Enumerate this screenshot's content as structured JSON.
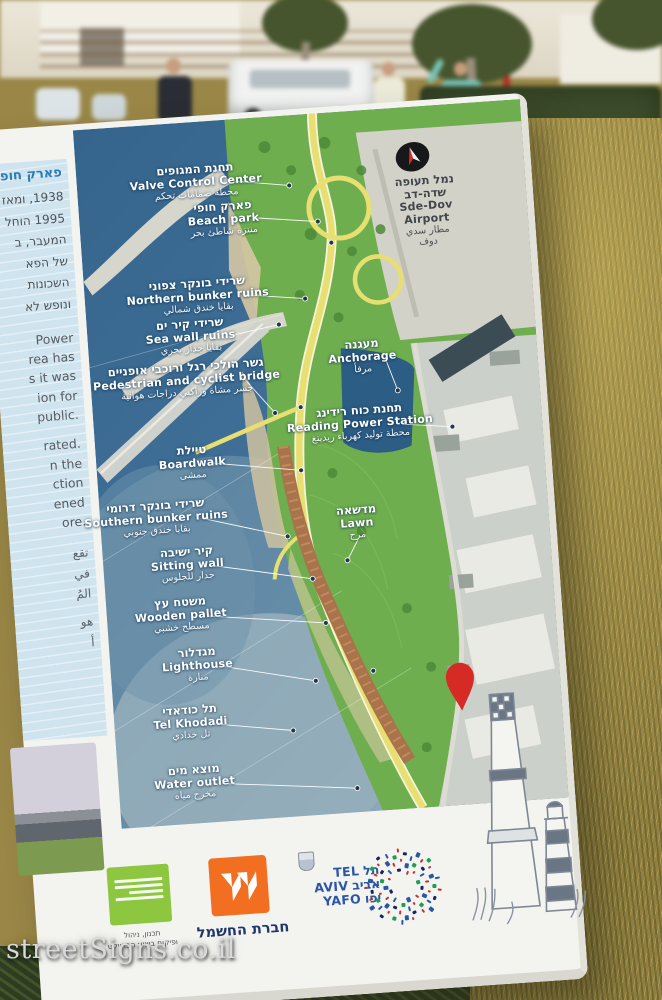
{
  "watermark": "streetSigns.co.il",
  "colors": {
    "sea": "#3f6f96",
    "park_green": "#6fae4e",
    "path_yellow": "#e7df72",
    "boardwalk_brown": "#a9744b",
    "urban_gray": "#cbd0ca",
    "column_blue": "#cfe4ef",
    "pin_red": "#d62a24",
    "iec_orange": "#f26f21",
    "tlv_blue": "#2b56a4",
    "logo_green": "#8dc63f"
  },
  "sign": {
    "left_column": {
      "title_fragment": "פארק חופ",
      "hebrew_fragments": [
        "1938, ומאז",
        "1995 הוחל",
        "המעבר, ב",
        "של הפא",
        "השכונות",
        "ונופש לא"
      ],
      "english_fragments": [
        "Power",
        "rea has",
        "s it was",
        "ion for",
        "public.",
        "rated.",
        "n the",
        "ction",
        "ened",
        "ore."
      ],
      "arabic_fragments": [
        "تقع",
        "في",
        "المُ",
        "هو",
        "أ"
      ]
    },
    "map": {
      "labels": [
        {
          "id": "valve",
          "he": "תחנת המגופים",
          "en": "Valve Control Center",
          "ar": "محطة صمامات تحكم"
        },
        {
          "id": "beach",
          "he": "פארק חופי",
          "en": "Beach park",
          "ar": "منتزه شاطئ بحر"
        },
        {
          "id": "nbunker",
          "he": "שרידי בונקר צפוני",
          "en": "Northern bunker ruins",
          "ar": "بقايا خندق شمالي"
        },
        {
          "id": "seawall",
          "he": "שרידי קיר ים",
          "en": "Sea wall ruins",
          "ar": "بقايا جدار بحري"
        },
        {
          "id": "bridge",
          "he": "גשר הולכי רגל ורוכבי אופניים",
          "en": "Pedestrian and cyclist bridge",
          "ar": "جسر مشاة وراكبي دراجات هوائية"
        },
        {
          "id": "anchorage",
          "he": "מעגנה",
          "en": "Anchorage",
          "ar": "مرفأ"
        },
        {
          "id": "reading",
          "he": "תחנת כוח רידינג",
          "en": "Reading Power Station",
          "ar": "محطة توليد كهرباء ريدينغ"
        },
        {
          "id": "boardwalk",
          "he": "טיילת",
          "en": "Boardwalk",
          "ar": "ممشى"
        },
        {
          "id": "lawn",
          "he": "מדשאה",
          "en": "Lawn",
          "ar": "مرج"
        },
        {
          "id": "sbunker",
          "he": "שרידי בונקר דרומי",
          "en": "Southern bunker ruins",
          "ar": "بقايا خندق جنوبي"
        },
        {
          "id": "sitting",
          "he": "קיר ישיבה",
          "en": "Sitting wall",
          "ar": "جدار للجلوس"
        },
        {
          "id": "wooden",
          "he": "משטח עץ",
          "en": "Wooden pallet",
          "ar": "مسطح خشبي"
        },
        {
          "id": "lighthouse",
          "he": "מגדלור",
          "en": "Lighthouse",
          "ar": "منارة"
        },
        {
          "id": "telkhodadi",
          "he": "תל כודאדי",
          "en": "Tel Khodadi",
          "ar": "تل خدادي"
        },
        {
          "id": "water",
          "he": "מוצא מים",
          "en": "Water outlet",
          "ar": "مخرج مياه"
        },
        {
          "id": "sdedov",
          "he": "נמל תעופה שדה-דב",
          "en": "Sde-Dov Airport",
          "ar": "مطار سدي دوف"
        }
      ]
    },
    "footer": {
      "green_logo_caption": [
        "תכנון, ניהול",
        "ופיקוח ביצוע הפרויקט"
      ],
      "iec_label": "חברת החשמל",
      "tlv": {
        "rows": [
          {
            "en": "TEL",
            "he": "תל"
          },
          {
            "en": "AVIV",
            "he": "אביב"
          },
          {
            "en": "YAFO",
            "he": "יפו"
          }
        ]
      }
    }
  }
}
